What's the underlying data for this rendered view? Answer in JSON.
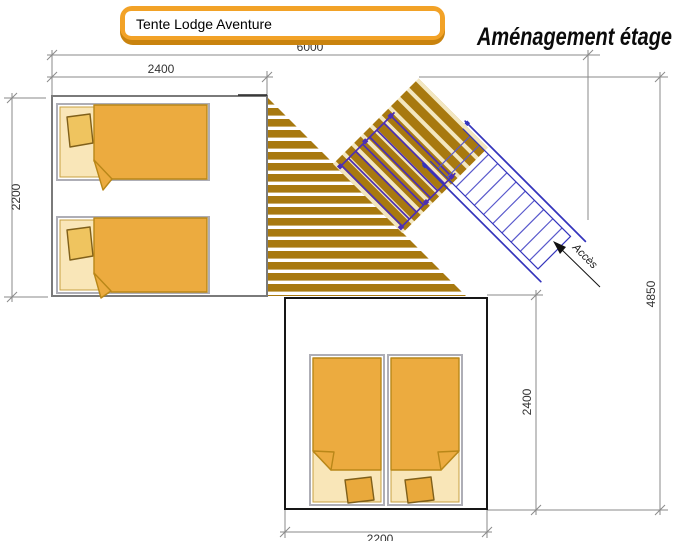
{
  "title_box": {
    "label": "Tente Lodge Aventure"
  },
  "heading": "Aménagement étage",
  "dimensions": {
    "overall_width": "6000",
    "left_room_width": "2400",
    "left_room_depth": "2200",
    "overall_depth": "4850",
    "bottom_room_depth": "2400",
    "bottom_room_width": "2200"
  },
  "labels": {
    "access": "Accès"
  },
  "colors": {
    "deck_brown": "#A8790F",
    "plank_gap_cream": "#F3E7C0",
    "blanket_orange": "#ECAB3F",
    "blanket_outline": "#B98718",
    "sheet_cream": "#F9E6B8",
    "sheet_outline": "#C8A040",
    "pillow_tan": "#EFC45F",
    "pillow_orange": "#E9A93C",
    "pillow_outline": "#80601A",
    "railing_violet": "#4C2FB4",
    "stair_blue": "#3434BC",
    "stair_step_blue": "#5858CC",
    "dim_gray": "#8A8A8A",
    "room_outline_gray": "#7A7A7A",
    "room_outline_black": "#161616",
    "bed_frame_gray": "#AEAEB6",
    "title_border_orange": "#F2A227",
    "title_border_shadow": "#C9830E"
  }
}
